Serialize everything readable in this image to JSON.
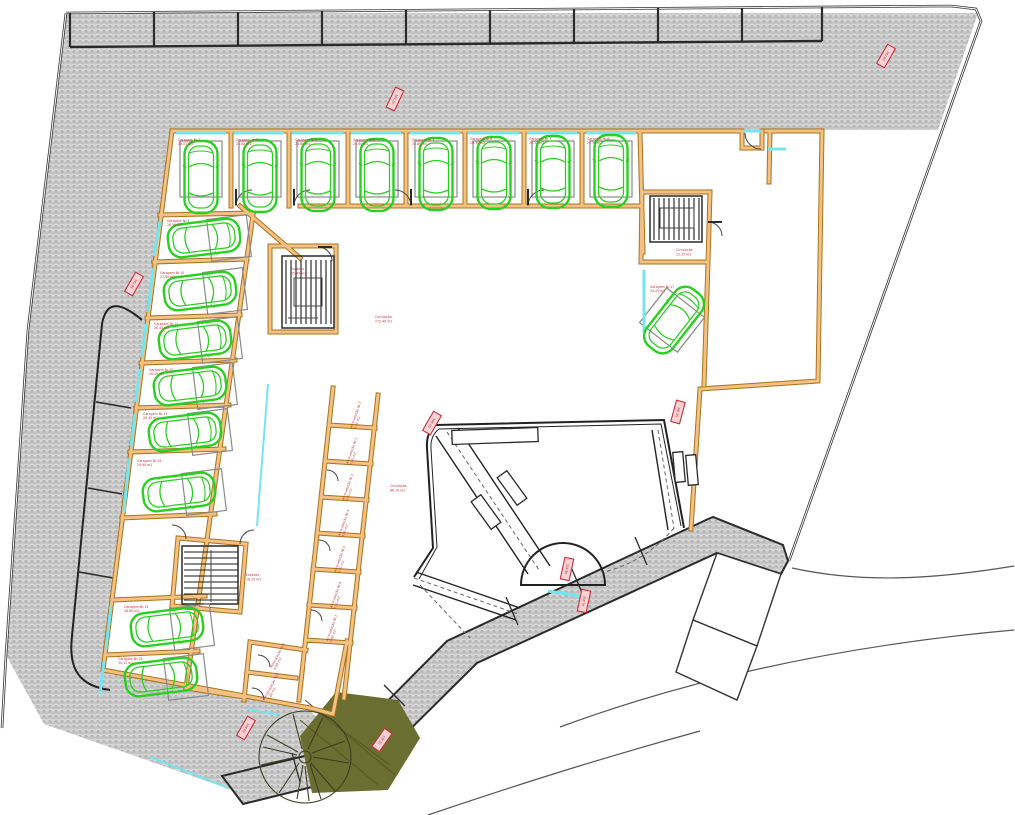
{
  "colors": {
    "wall_orange": "#e8a24b",
    "wall_outline": "#a9731c",
    "car_green": "#2bcf22",
    "accent_cyan": "#74e6ef",
    "label_red": "#c23441",
    "hatch_gray": "#d6d6d6",
    "tree_olive": "#6b6e31"
  },
  "icons": {
    "car": "car-top-view-icon",
    "tree": "tree-icon",
    "stairs": "stairs-icon"
  },
  "garages": [
    {
      "label": "Garagem Nr.1",
      "area": "25.07 m2"
    },
    {
      "label": "Garagem Nr.2",
      "area": "24.80 m2"
    },
    {
      "label": "Garagem Nr.3",
      "area": "24.80 m2"
    },
    {
      "label": "Garagem Nr.4",
      "area": "24.80 m2"
    },
    {
      "label": "Garagem Nr.5",
      "area": "24.80 m2"
    },
    {
      "label": "Garagem Nr.6",
      "area": "26.10 m2"
    },
    {
      "label": "Garagem Nr.7",
      "area": "26.10 m2"
    },
    {
      "label": "Garagem Nr.8",
      "area": "27.35 m2"
    },
    {
      "label": "Garagem Nr.9",
      "area": "26.50 m2"
    },
    {
      "label": "Garagem Nr.10",
      "area": "27.80 m2"
    },
    {
      "label": "Garagem Nr.11",
      "area": "26.45 m2"
    },
    {
      "label": "Garagem Nr.12",
      "area": "26.45 m2"
    },
    {
      "label": "Garagem Nr.13",
      "area": "26.45 m2"
    },
    {
      "label": "Garagem Nr.14",
      "area": "29.90 m2"
    },
    {
      "label": "Garagem Nr.15",
      "area": "28.60 m2"
    },
    {
      "label": "Garagem Nr.16",
      "area": "30.15 m2"
    },
    {
      "label": "Garagem Nr.17",
      "area": "34.20 m2"
    }
  ],
  "storage": [
    {
      "label": "Arrecadação Nr.1",
      "area": "5.20 m2"
    },
    {
      "label": "Arrecadação Nr.2",
      "area": "5.10 m2"
    },
    {
      "label": "Arrecadação Nr.3",
      "area": "4.95 m2"
    },
    {
      "label": "Arrecadação Nr.4",
      "area": "4.95 m2"
    },
    {
      "label": "Arrecadação Nr.5",
      "area": "5.05 m2"
    },
    {
      "label": "Arrecadação Nr.6",
      "area": "5.15 m2"
    },
    {
      "label": "Arrecadação Nr.7",
      "area": "5.60 m2"
    },
    {
      "label": "Arrecadação Nr.8",
      "area": "6.90 m2"
    },
    {
      "label": "Arrecadação Nr.9",
      "area": "7.60 m2"
    }
  ],
  "rooms": {
    "circulation_main": {
      "label": "Circulação",
      "area": "272.40 m2"
    },
    "circulation_south": {
      "label": "Circulação",
      "area": "86.10 m2"
    },
    "lobby": {
      "label": "Circulação",
      "area": "12.35 m2"
    },
    "stairs_upper": {
      "label": "Escadas",
      "area": "15.40 m2"
    },
    "stairs_lower": {
      "label": "Escadas",
      "area": "16.20 m2"
    }
  },
  "markers": [
    {
      "label": "343.15"
    },
    {
      "label": "342.60"
    },
    {
      "label": "341.95"
    },
    {
      "label": "340.10"
    },
    {
      "label": "340.25"
    },
    {
      "label": "338.90"
    },
    {
      "label": "338.75"
    },
    {
      "label": "339.40"
    },
    {
      "label": "339.10"
    }
  ]
}
